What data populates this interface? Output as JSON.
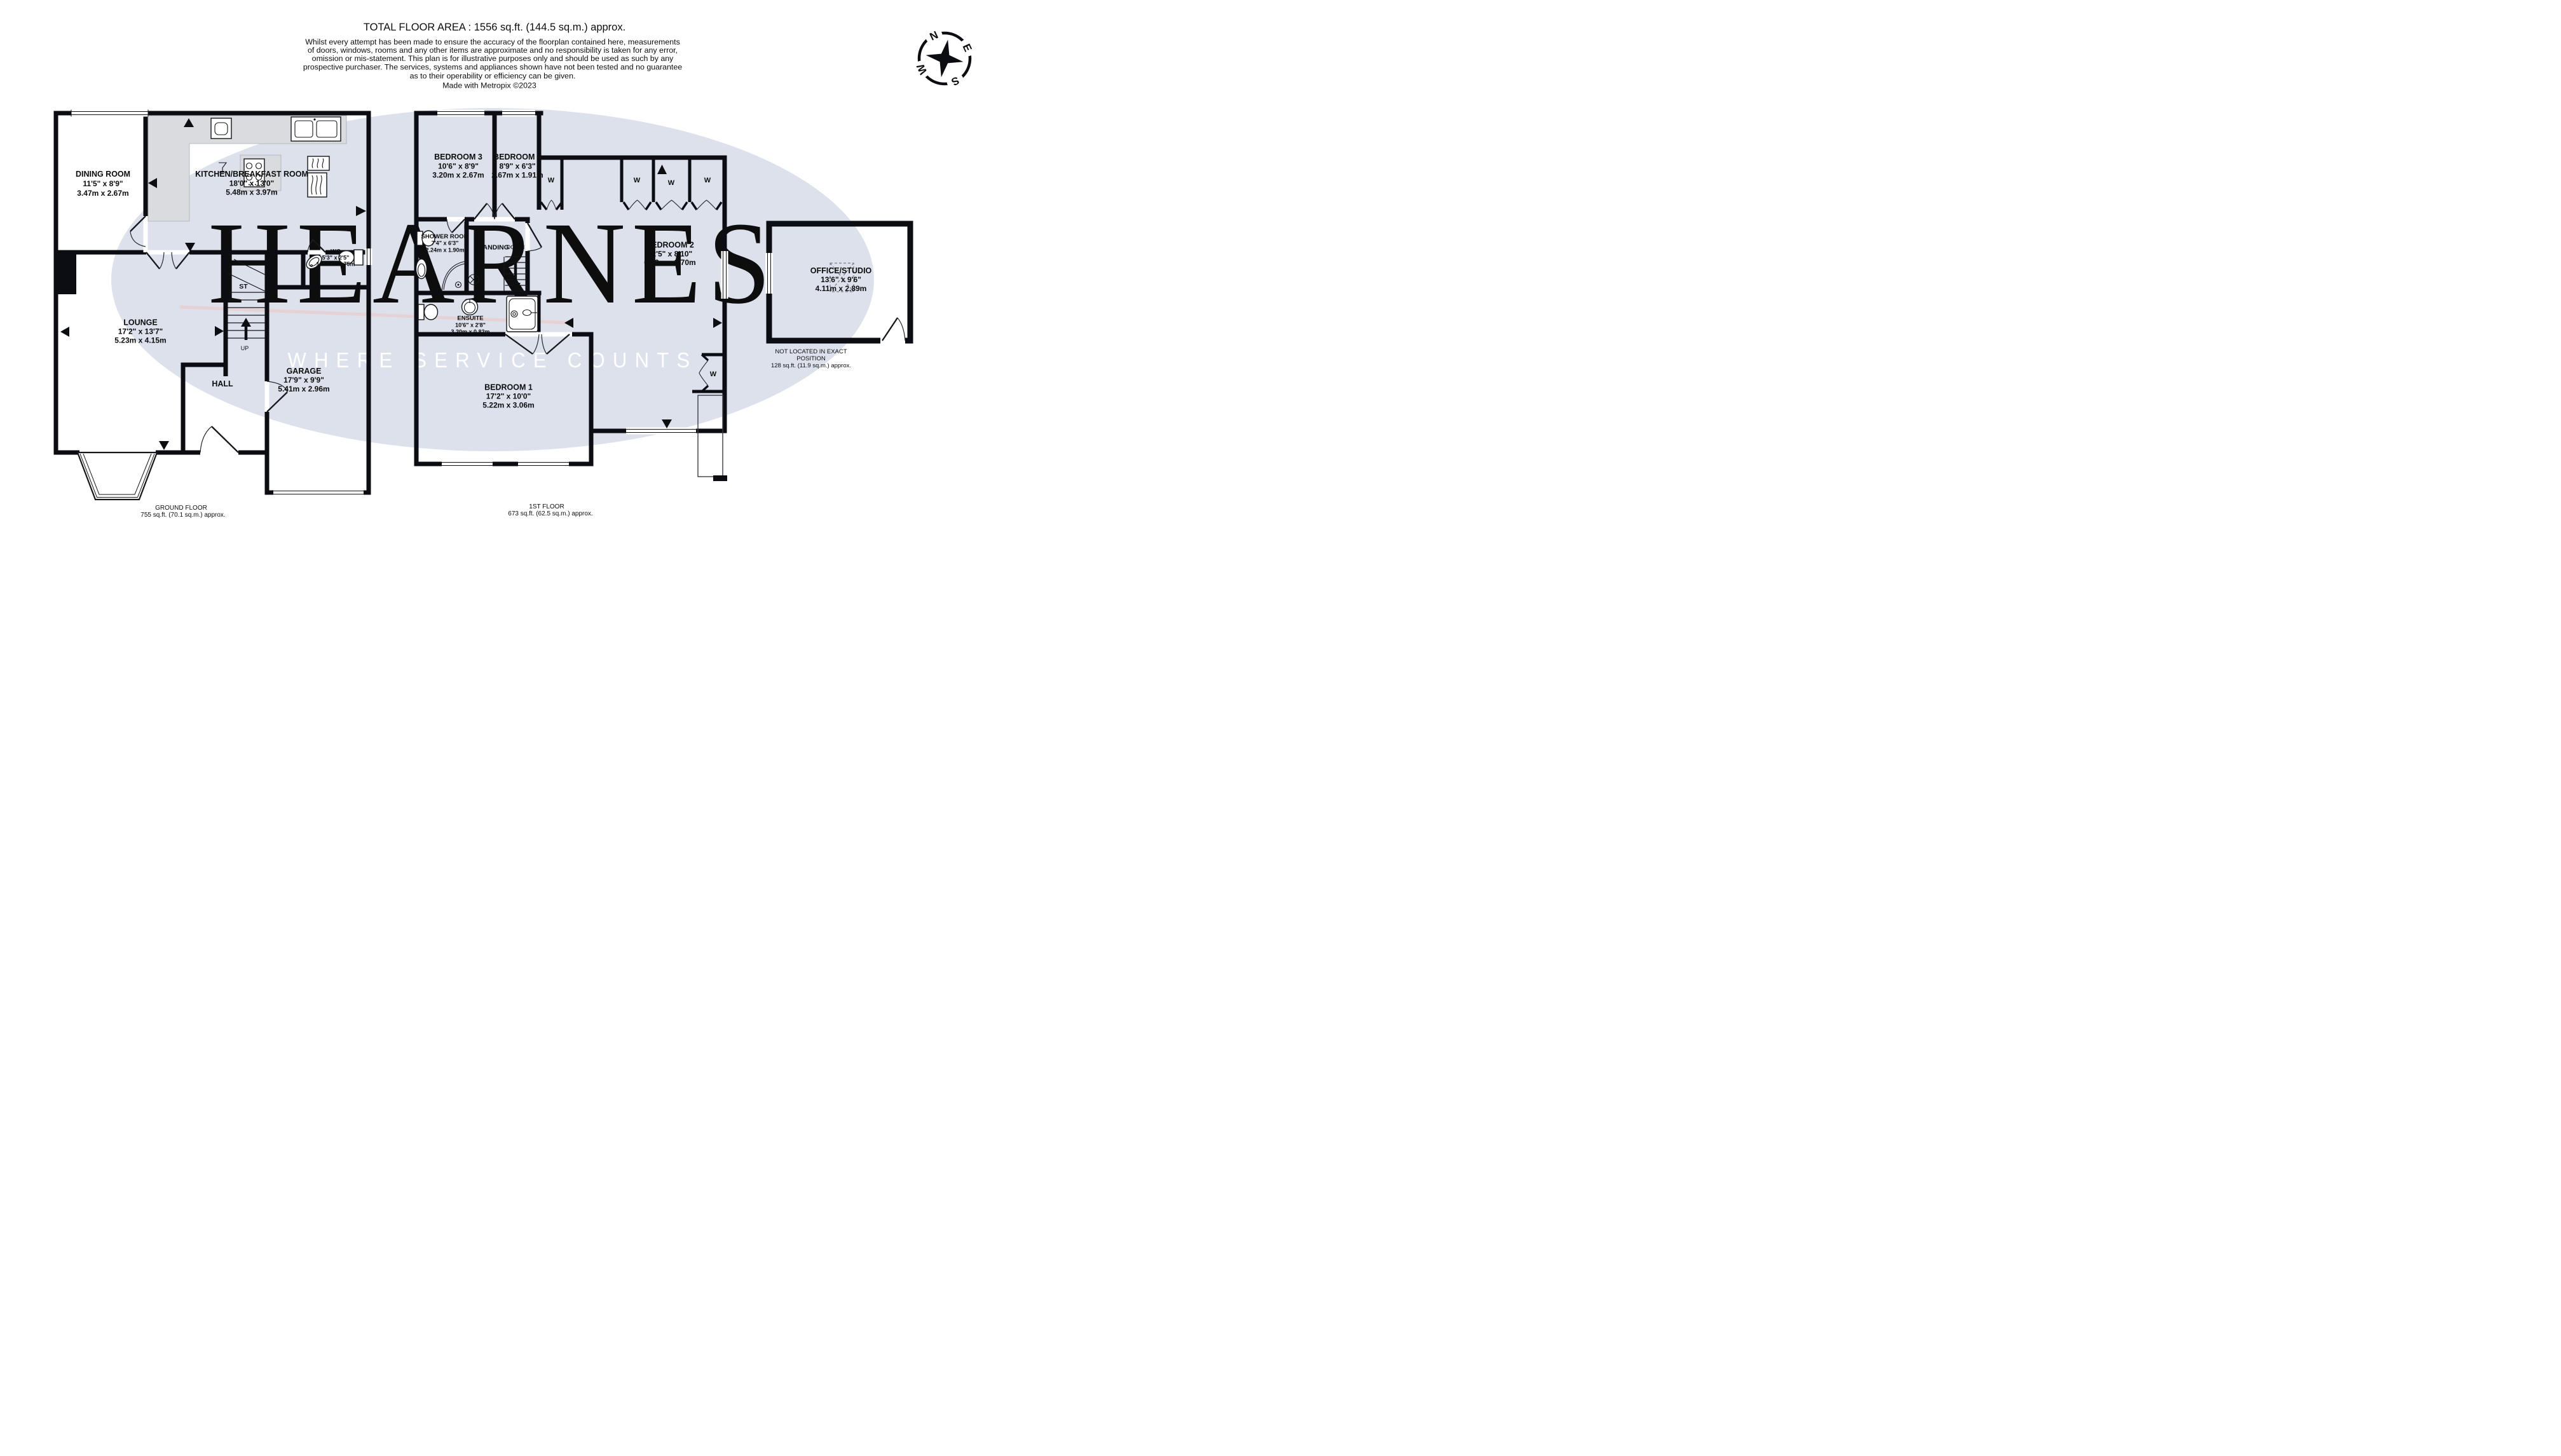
{
  "header": {
    "title": "TOTAL FLOOR AREA : 1556 sq.ft. (144.5 sq.m.) approx.",
    "disclaimer": [
      "Whilst every attempt has been made to ensure the accuracy of the floorplan contained here, measurements",
      "of doors, windows, rooms and any other items are approximate and no responsibility is taken for any error,",
      "omission or mis-statement. This plan is for illustrative purposes only and should be used as such by any",
      "prospective purchaser. The services, systems and appliances shown have not been tested and no guarantee",
      "as to their operability or efficiency can be given."
    ],
    "credit": "Made with Metropix ©2023"
  },
  "compass": {
    "n": "N",
    "e": "E",
    "s": "S",
    "w": "W"
  },
  "watermark": {
    "brand": "HEARNES",
    "tagline": "WHERE SERVICE COUNTS"
  },
  "rooms": {
    "dining": {
      "name": "DINING ROOM",
      "imperial": "11'5\"  x 8'9\"",
      "metric": "3.47m  x 2.67m"
    },
    "kitchen": {
      "name": "KITCHEN/BREAKFAST ROOM",
      "imperial": "18'0\"  x 13'0\"",
      "metric": "5.48m  x 3.97m"
    },
    "wc": {
      "name": "WC",
      "imperial": "5'3\"  x 2'5\"",
      "metric": "1.60m  x 0.75m"
    },
    "lounge": {
      "name": "LOUNGE",
      "imperial": "17'2\"  x 13'7\"",
      "metric": "5.23m  x 4.15m"
    },
    "garage": {
      "name": "GARAGE",
      "imperial": "17'9\"  x 9'9\"",
      "metric": "5.41m  x 2.96m"
    },
    "hall": {
      "name": "HALL"
    },
    "st": {
      "name": "ST"
    },
    "bedroom3": {
      "name": "BEDROOM 3",
      "imperial": "10'6\"  x 8'9\"",
      "metric": "3.20m  x 2.67m"
    },
    "bedroom4": {
      "name": "BEDROOM 4",
      "imperial": "8'9\"  x 6'3\"",
      "metric": "2.67m  x 1.91m"
    },
    "shower": {
      "name": "SHOWER ROOM",
      "imperial": "7'4\"  x 6'3\"",
      "metric": "2.24m  x 1.90m"
    },
    "landing": {
      "name": "LANDING"
    },
    "bedroom2": {
      "name": "BEDROOM 2",
      "imperial": "22'5\"  x 8'10\"",
      "metric": "6.83m  x 2.70m"
    },
    "ensuite": {
      "name": "ENSUITE",
      "imperial": "10'6\"  x 2'8\"",
      "metric": "3.20m  x 0.82m"
    },
    "bedroom1": {
      "name": "BEDROOM 1",
      "imperial": "17'2\"  x 10'0\"",
      "metric": "5.22m  x 3.06m"
    },
    "office": {
      "name": "OFFICE/STUDIO",
      "imperial": "13'6\"  x 9'6\"",
      "metric": "4.11m  x 2.89m"
    }
  },
  "annotations": {
    "up": "UP",
    "down": "DOWN",
    "wardrobe": "W",
    "office_note_1": "NOT LOCATED IN EXACT",
    "office_note_2": "POSITION",
    "office_note_3": "128 sq.ft. (11.9 sq.m.) approx."
  },
  "floors": {
    "ground": {
      "label": "GROUND FLOOR",
      "area": "755 sq.ft. (70.1 sq.m.) approx."
    },
    "first": {
      "label": "1ST FLOOR",
      "area": "673 sq.ft. (62.5 sq.m.) approx."
    }
  },
  "colors": {
    "wall": "#0b0d12",
    "watermark_ellipse": "#dce1ec",
    "brand_text": "#f6eec8",
    "tagline_text": "#ffffff",
    "counter": "#d9dbde",
    "accent_line": "#edc9c5"
  }
}
